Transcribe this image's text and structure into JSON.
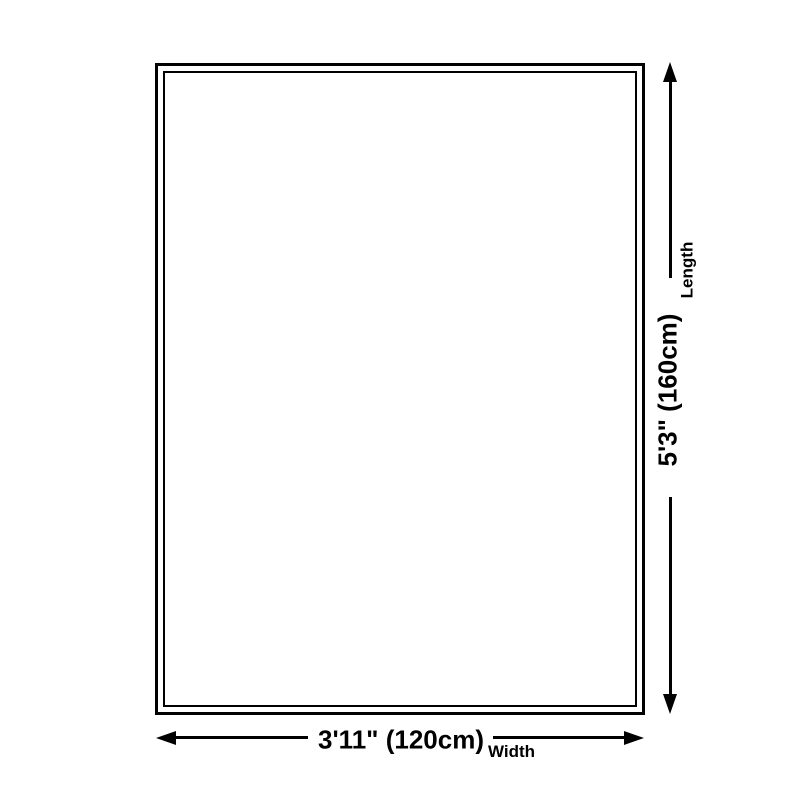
{
  "diagram": {
    "dimensions": {
      "length": {
        "value": "5'3\" (160cm)",
        "label": "Length"
      },
      "width": {
        "value": "3'11\" (120cm)",
        "label": "Width"
      }
    },
    "colors": {
      "line": "#000000",
      "background": "#ffffff"
    },
    "icons": {
      "arrow_up": "css-triangle-up",
      "arrow_down": "css-triangle-down",
      "arrow_left": "css-triangle-left",
      "arrow_right": "css-triangle-right"
    }
  }
}
